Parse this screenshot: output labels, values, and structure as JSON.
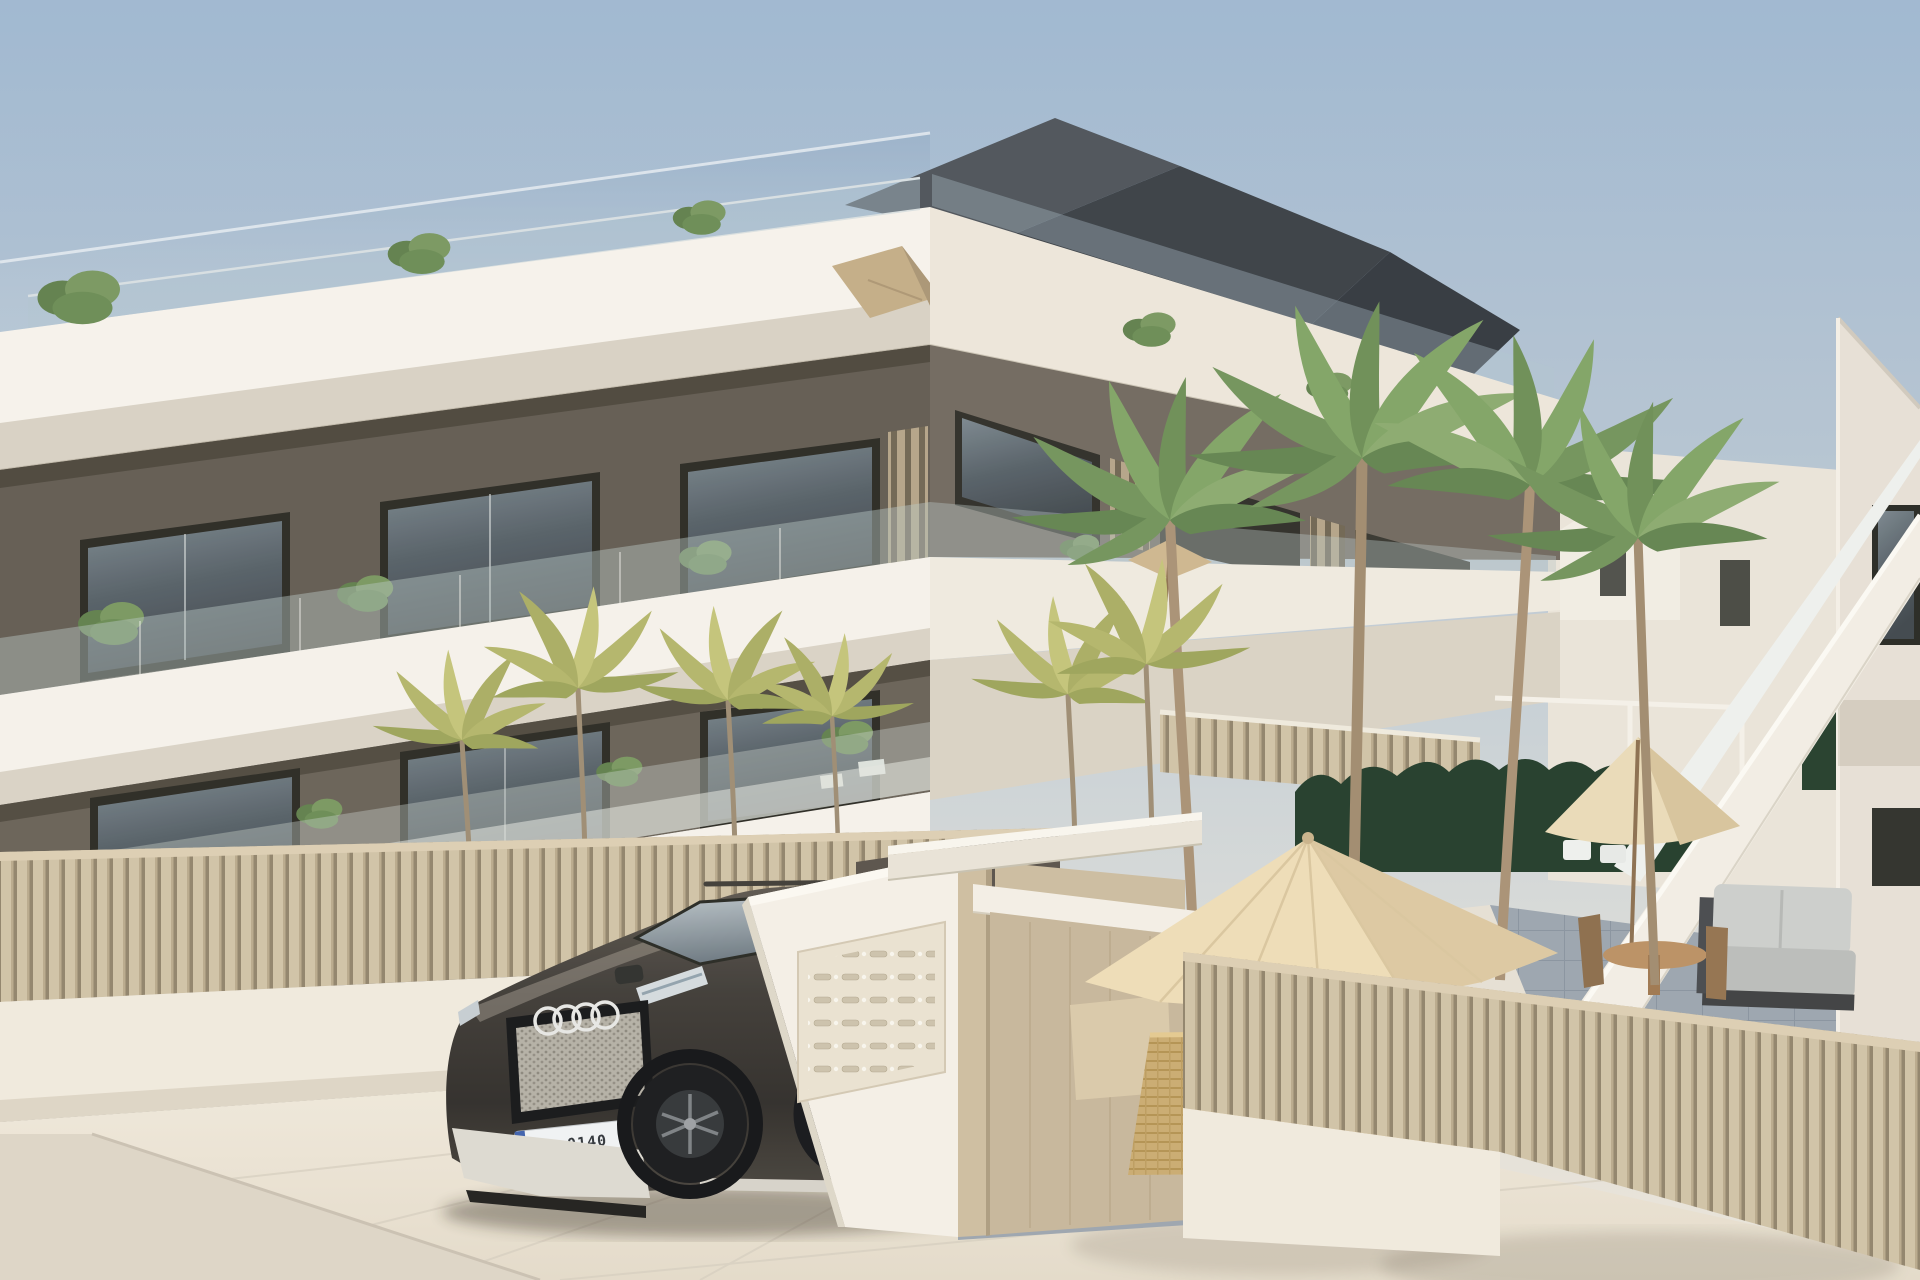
{
  "scene": {
    "title": "Architectural 3D render — modern three-storey apartment complex with courtyard",
    "setting": "daytime, clear pale-blue sky, Mediterranean style",
    "style": "exterior visualization, no UI elements, no captions"
  },
  "car": {
    "type_hint": "dark Audi SUV parked at entrance",
    "license_plate": "NA 0140",
    "body_color": "#3a3530"
  },
  "palette": {
    "sky_top": "#9db6d0",
    "sky_horizon": "#e9e3d8",
    "slab_white": "#f5f1ea",
    "soffit": "#d7d0c3",
    "wall_taupe": "#665e54",
    "recess_dark": "#57514a",
    "fence_beige": "#cdbfa3",
    "fence_shadow": "#8f8169",
    "roof_dark": "#42474e",
    "glass_window": "#4a545c",
    "palm_green": "#7e9c62",
    "palm_yellow": "#b5b772",
    "hedge_green": "#1e3826",
    "parasol_cream": "#eedcb6",
    "pavement": "#ece5d8",
    "terrace_tile": "#98a2ac",
    "gate_white": "#f2ede4",
    "pillar_beige": "#cdbc9f"
  },
  "objects": {
    "labels": [
      "apartment building with white slab balconies",
      "glass balustrades with plants",
      "dark hip roof and glass canopy",
      "beige vertical-slat fences",
      "mailbox wall and entrance gate",
      "dark Audi SUV",
      "tall palm trees and small yellow palms",
      "dark green hedge",
      "cream parasols with dining set",
      "white exterior staircase",
      "right white building",
      "stone pavement foreground"
    ]
  }
}
